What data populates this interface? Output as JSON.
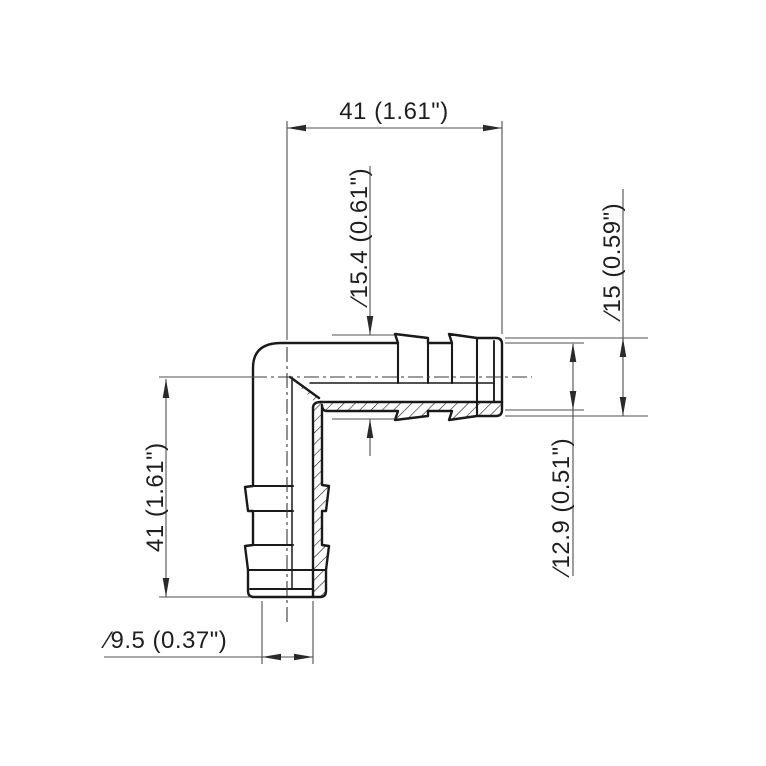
{
  "drawing": {
    "dimensions": {
      "top_length": "41  (1.61\")",
      "left_length": "41  (1.61\")",
      "barb_od": "∕15.4  (0.61\")",
      "end_od": "∕15  (0.59\")",
      "shank_od": "∕12.9  (0.51\")",
      "bore_id": "∕9.5  (0.37\")"
    },
    "colors": {
      "outline": "#1a1a1a",
      "dim_line": "#4f4f4f",
      "text": "#1f1f1f",
      "background": "#ffffff"
    }
  }
}
